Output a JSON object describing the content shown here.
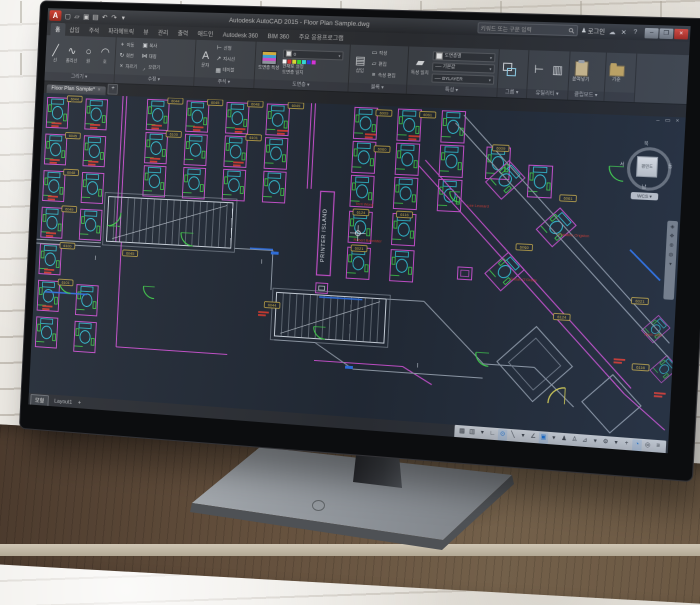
{
  "window": {
    "app_button_label": "A",
    "title": "Autodesk AutoCAD 2015 - Floor Plan Sample.dwg",
    "qat_icons": [
      "new-file-icon",
      "open-file-icon",
      "save-icon",
      "print-icon",
      "undo-icon",
      "redo-icon",
      "qat-dropdown-icon"
    ],
    "infocenter": {
      "search_placeholder": "키워드 또는 구문 입력",
      "signin_label": "로그인"
    },
    "window_buttons": {
      "minimize": "–",
      "restore": "❒",
      "close": "×"
    }
  },
  "ribbon": {
    "tabs": [
      {
        "label": "홈",
        "active": true
      },
      {
        "label": "삽입"
      },
      {
        "label": "주석"
      },
      {
        "label": "파라메트릭"
      },
      {
        "label": "뷰"
      },
      {
        "label": "관리"
      },
      {
        "label": "출력"
      },
      {
        "label": "애드인"
      },
      {
        "label": "Autodesk 360"
      },
      {
        "label": "BIM 360"
      },
      {
        "label": "주요 응용프로그램"
      }
    ],
    "panels": [
      {
        "label": "그리기",
        "buttons": [
          "선",
          "폴리선",
          "원",
          "호"
        ]
      },
      {
        "label": "수정",
        "buttons": [
          "이동",
          "회전",
          "자르기",
          "복사",
          "대칭",
          "모깎기"
        ]
      },
      {
        "label": "주석",
        "buttons": [
          "문자",
          "선형",
          "지시선",
          "테이블"
        ]
      },
      {
        "label": "도면층",
        "buttons": [
          "도면층 특성",
          "현재로 설정",
          "도면층 일치"
        ]
      },
      {
        "label": "블록",
        "buttons": [
          "삽입",
          "작성",
          "편집",
          "속성 편집"
        ]
      },
      {
        "label": "특성",
        "buttons": [
          "특성 일치"
        ],
        "values": {
          "color": "도면층별",
          "lineweight": "기본값",
          "linetype": "BYLAYER"
        }
      },
      {
        "label": "그룹",
        "buttons": []
      },
      {
        "label": "유틸리티",
        "buttons": []
      },
      {
        "label": "클립보드",
        "buttons": [
          "붙여넣기"
        ]
      },
      {
        "label": "",
        "buttons": [
          "기준"
        ]
      }
    ]
  },
  "file_tabs": {
    "tabs": [
      {
        "label": "Floor Plan Sample*",
        "active": true
      }
    ],
    "new_tab_label": "+"
  },
  "drawing": {
    "printer_island_label": "PRINTER ISLAND",
    "room_tags": [
      "6044",
      "6045",
      "6048",
      "6049",
      "6100",
      "6101",
      "6009",
      "6061",
      "6060",
      "6124",
      "6116",
      "6021"
    ],
    "occupant_names": [
      "Terri Wong",
      "Robert Bannister",
      "Susan O'Grady",
      "Lee Leonard",
      "Christine Ongston",
      "April Jobs"
    ],
    "colors": {
      "background": "#222a36",
      "walls": "#cdd5df",
      "wall_gray": "#8f99a6",
      "partitions": "#c44fca",
      "furniture": "#33c4d8",
      "panels_green": "#41cf4b",
      "tags_yellow": "#d2b44a",
      "names_red": "#cb392f",
      "accent_blue": "#2e6fe0",
      "door_yellow": "#d5cd52"
    }
  },
  "viewcube": {
    "north": "북",
    "west": "서",
    "east": "동",
    "south": "남",
    "face": "평면도",
    "wcs": "WCS ▾"
  },
  "status_bar": {
    "model_tab": "모형",
    "layout_tab": "Layout1",
    "add_layout_label": "+",
    "toggles": [
      {
        "name": "grid-display-toggle",
        "glyph": "▦"
      },
      {
        "name": "snap-mode-toggle",
        "glyph": "▥"
      },
      {
        "name": "snap-dropdown",
        "glyph": "▾"
      },
      {
        "name": "infer-constraints-toggle",
        "glyph": "∟"
      },
      {
        "name": "dynamic-input-toggle",
        "glyph": "⊙",
        "active": true
      },
      {
        "name": "ortho-mode-toggle",
        "glyph": "╲"
      },
      {
        "name": "polar-tracking-dropdown",
        "glyph": "▾"
      },
      {
        "name": "isometric-drafting-toggle",
        "glyph": "∠"
      },
      {
        "name": "object-snap-toggle",
        "glyph": "▣",
        "active": true
      },
      {
        "name": "osnap-dropdown",
        "glyph": "▾"
      },
      {
        "name": "annotation-visibility-toggle",
        "glyph": "♟"
      },
      {
        "name": "annotation-autoscale-toggle",
        "glyph": "♙"
      },
      {
        "name": "annotation-scale-button",
        "glyph": "⊿"
      },
      {
        "name": "scale-dropdown",
        "glyph": "▾"
      },
      {
        "name": "workspace-switching-button",
        "glyph": "⚙"
      },
      {
        "name": "workspace-dropdown",
        "glyph": "▾"
      },
      {
        "name": "clean-screen-button",
        "glyph": "+"
      },
      {
        "name": "graphics-performance-toggle",
        "glyph": "◔",
        "active": true
      },
      {
        "name": "isolate-objects-button",
        "glyph": "◎"
      },
      {
        "name": "customization-button",
        "glyph": "≡"
      }
    ]
  }
}
